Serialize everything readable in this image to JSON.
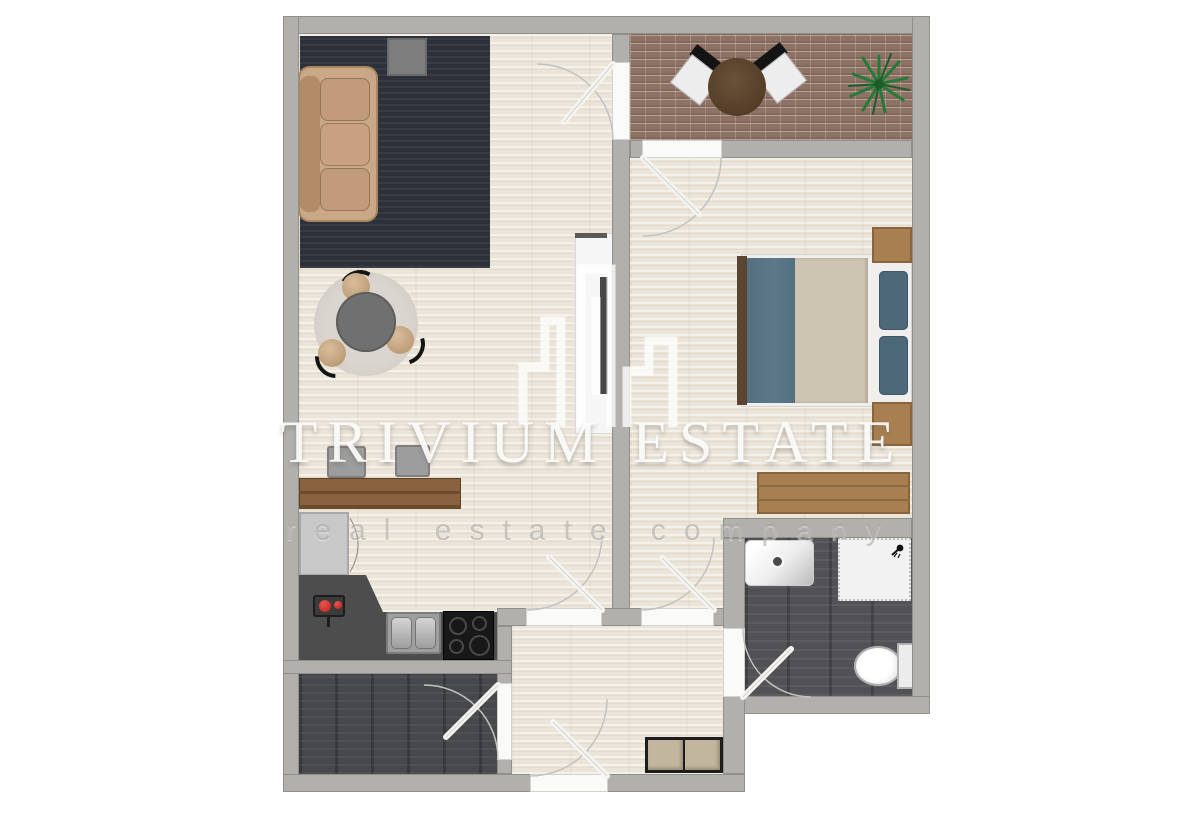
{
  "watermark": {
    "title": "TRIVIUM ESTATE",
    "subtitle": "real estate company",
    "logo": "trivium-buildings-logo"
  },
  "palette": {
    "wall": "#b1b0ad",
    "floor_light": "#ebe4d8",
    "floor_dark": "#515156",
    "floor_storage": "#46484c",
    "brick": "#8d7265",
    "rug": "#2e313a",
    "counter": "#4e4d4d",
    "wood": "#a87f50",
    "desk_wood": "#8a6240",
    "sofa": "#c9a886",
    "blanket_blue": "#5d7889",
    "duvet_beige": "#cec4b2",
    "pillow_blue": "#4d6879",
    "headboard_brown": "#5c4433",
    "knob_red": "#c11f1c",
    "plant_green": "#2d7a3c",
    "table_gray": "#707070",
    "cabinet_beige": "#c2b69e"
  }
}
